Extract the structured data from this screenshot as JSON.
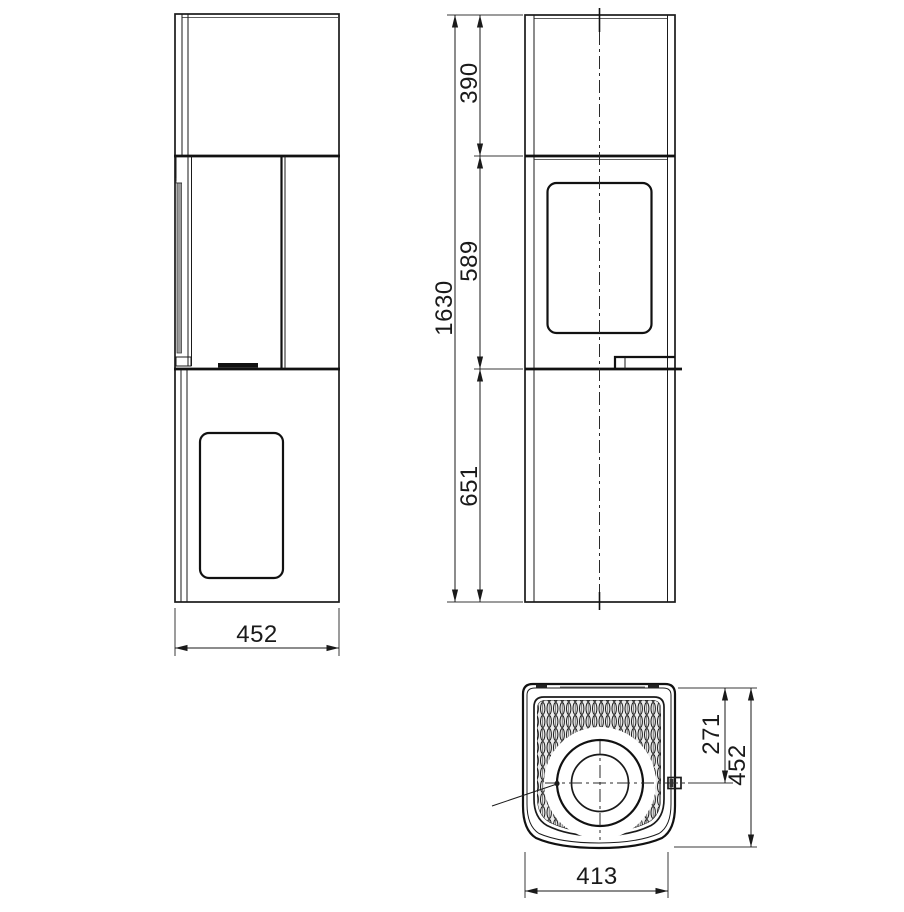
{
  "drawing": {
    "side_view": {
      "width_label": "452"
    },
    "front_view": {
      "total_height_label": "1630",
      "top_section_label": "390",
      "middle_section_label": "589",
      "base_section_label": "651"
    },
    "top_view": {
      "flue_center_label": "271",
      "depth_label": "452",
      "width_label": "413"
    }
  },
  "colors": {
    "line": "#1a1a1a",
    "bold_line": "#111111",
    "shade": "#9a9a9a",
    "background": "#ffffff"
  }
}
